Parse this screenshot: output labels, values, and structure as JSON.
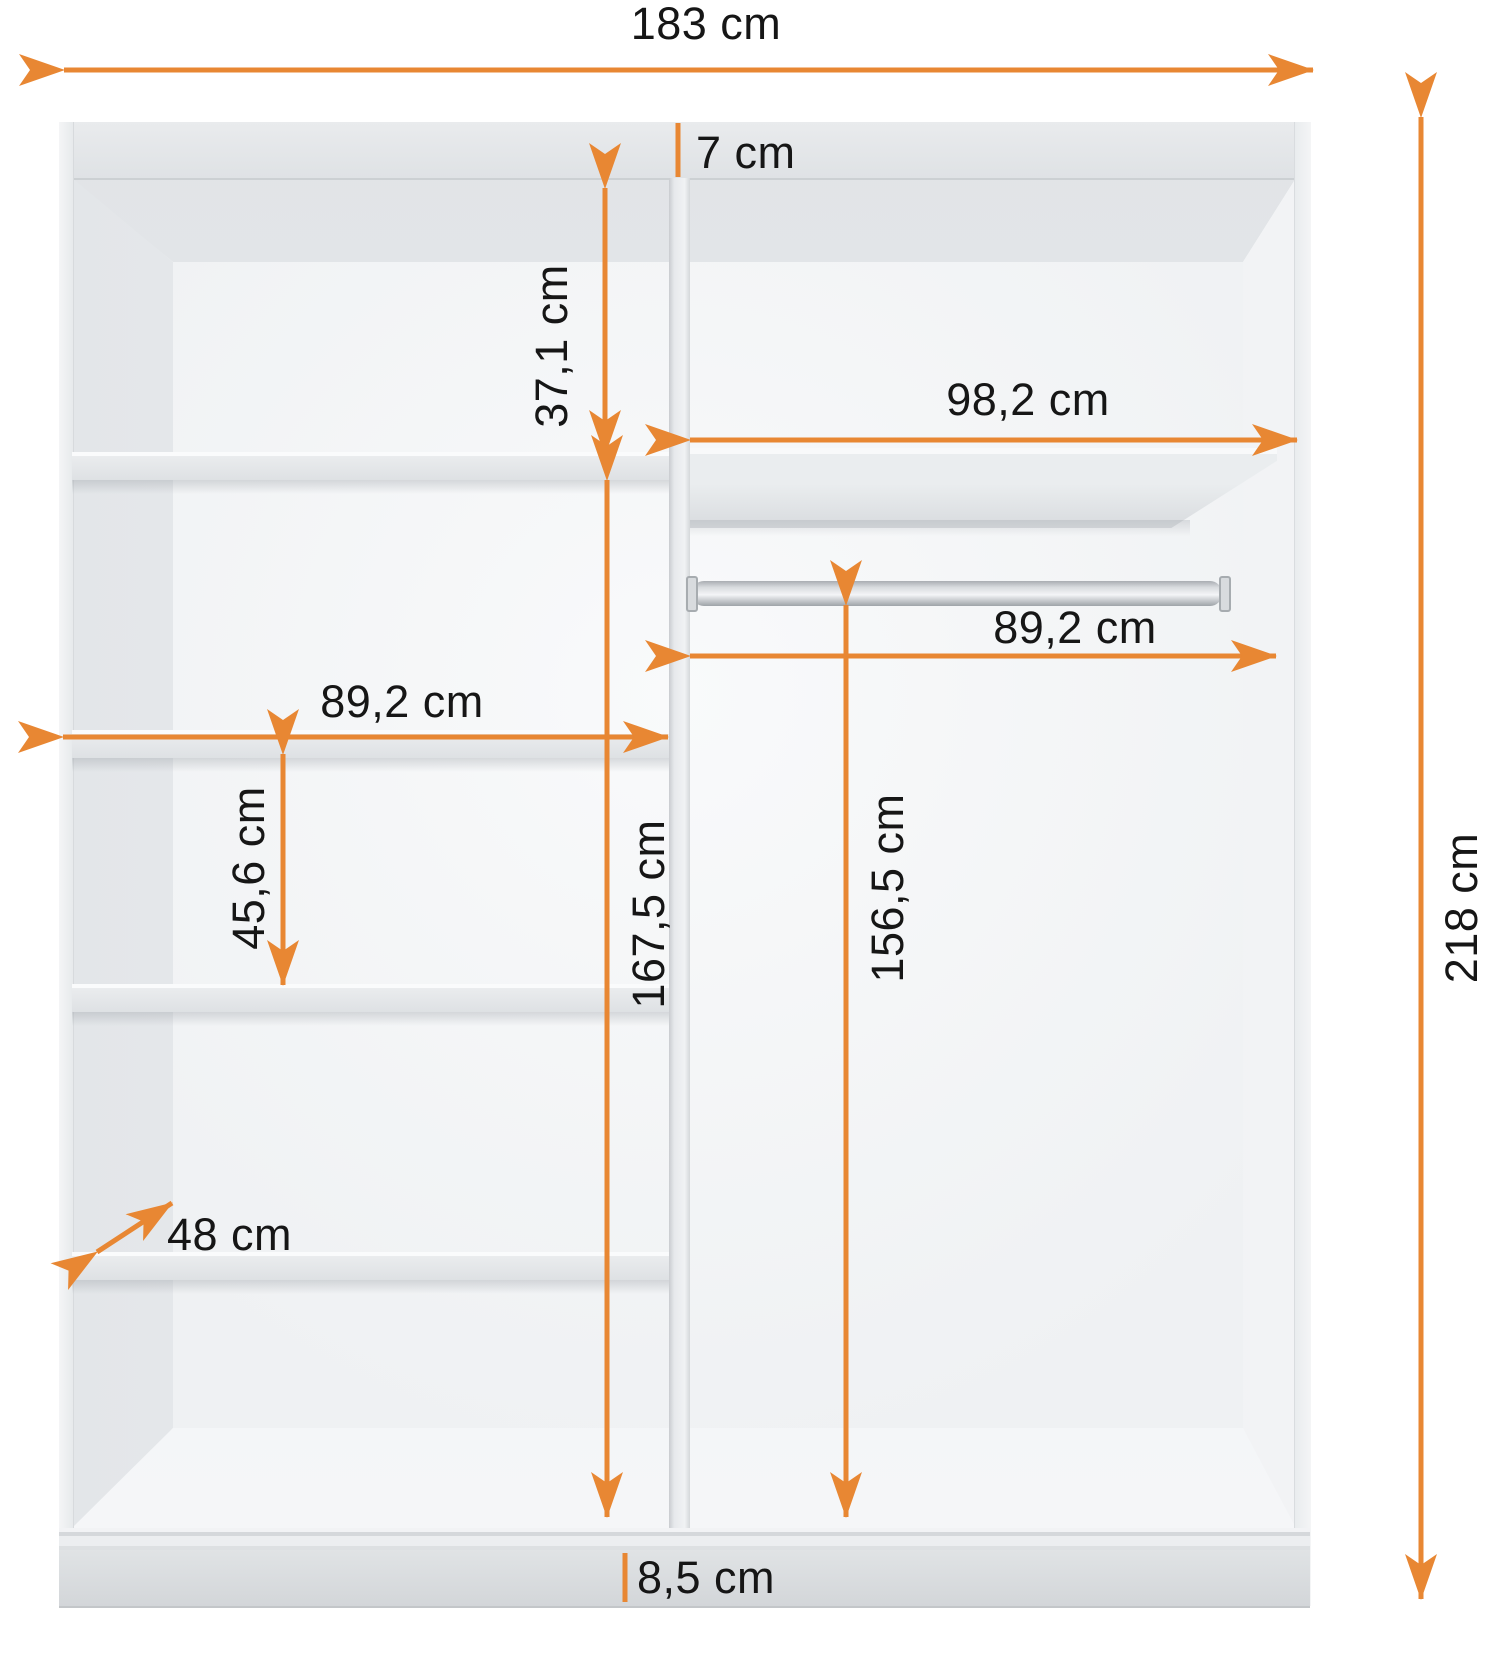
{
  "diagram": {
    "type": "furniture-dimension-diagram",
    "subject": "wardrobe interior front view with shelves and hanging rod"
  },
  "colors": {
    "accent": "#E88733",
    "label_text": "#161616",
    "background": "#FFFFFF",
    "cabinet_panel": "#E3E6E8"
  },
  "dims": {
    "total_width": {
      "label": "183 cm"
    },
    "total_height": {
      "label": "218 cm"
    },
    "top_panel": {
      "label": "7 cm"
    },
    "upper_shelf_gap": {
      "label": "37,1 cm"
    },
    "right_compartment_width": {
      "label": "98,2 cm"
    },
    "rod_length": {
      "label": "89,2 cm"
    },
    "rod_clearance_height": {
      "label": "156,5 cm"
    },
    "left_shelf_width": {
      "label": "89,2 cm"
    },
    "shelf_spacing": {
      "label": "45,6 cm"
    },
    "left_compartment_height": {
      "label": "167,5 cm"
    },
    "depth": {
      "label": "48 cm"
    },
    "plinth_height": {
      "label": "8,5 cm"
    }
  }
}
